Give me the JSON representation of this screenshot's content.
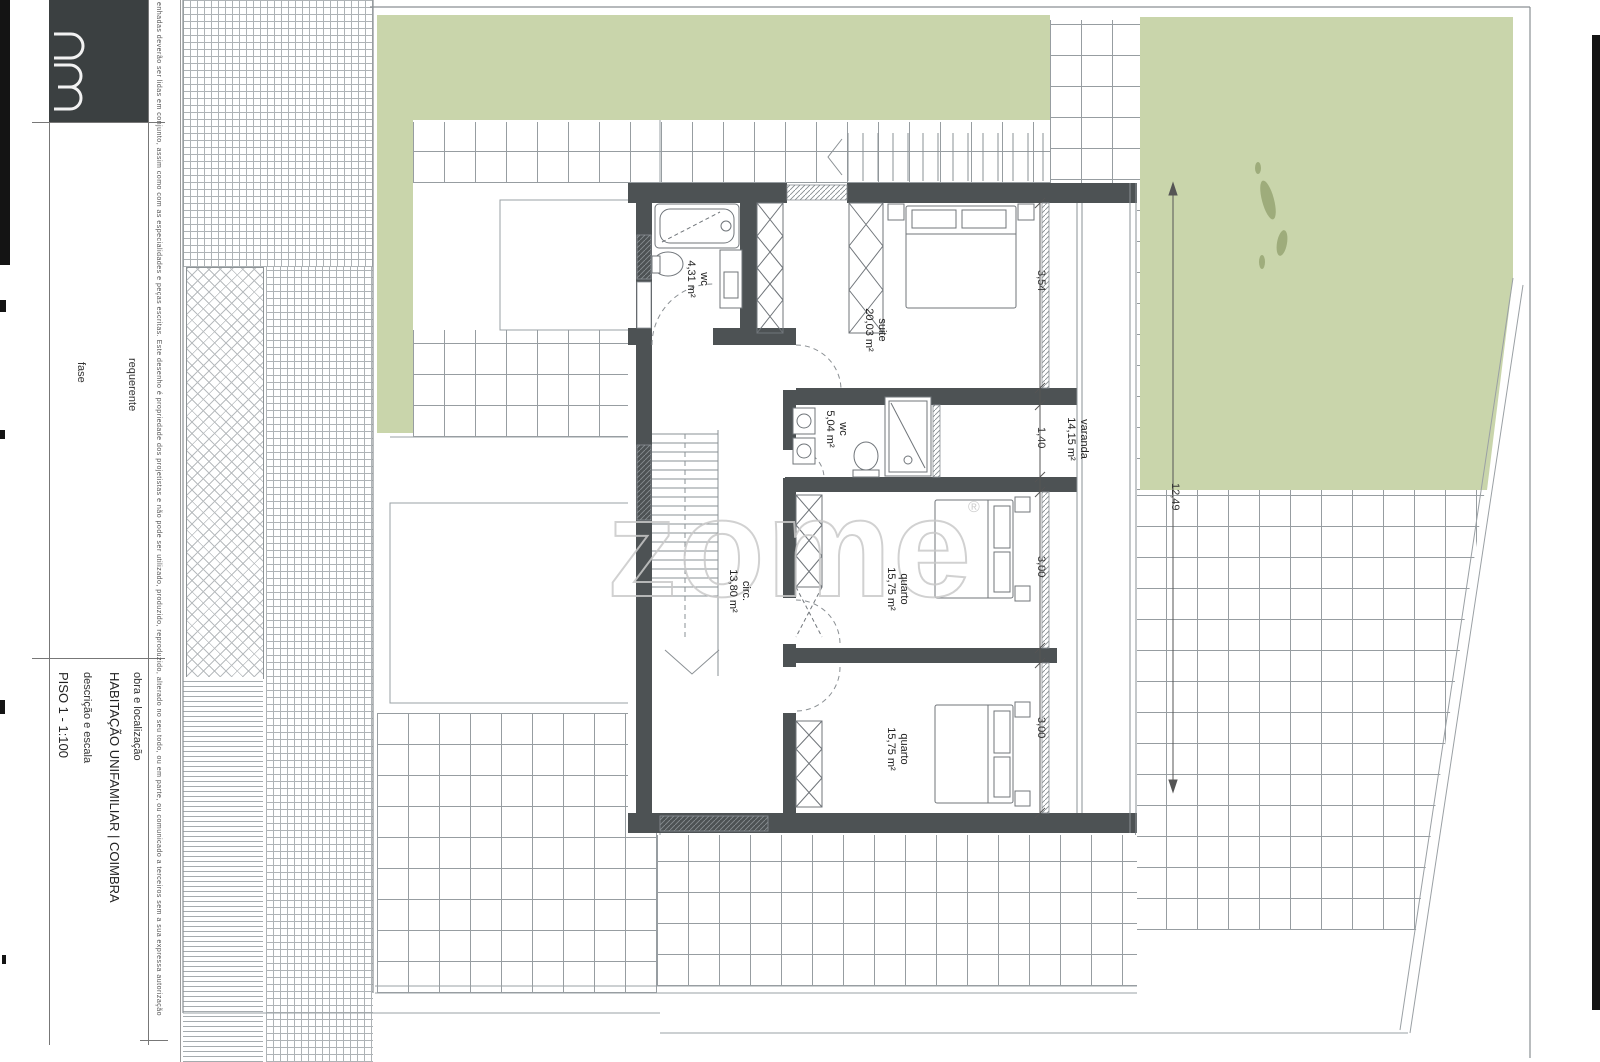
{
  "title_block": {
    "fields": [
      {
        "label": "requerente",
        "value": ""
      },
      {
        "label": "fase",
        "value": ""
      },
      {
        "label": "obra e localização",
        "value": "HABITAÇÃO UNIFAMILIAR | COIMBRA"
      },
      {
        "label": "descrição e escala",
        "value": "PISO 1 - 1:100"
      }
    ],
    "disclaimer": "enhadas deverão ser lidas em conjunto, assim como com as especialidades e peças escritas. Este desenho é propriedade dos projetistas e não pode ser utilizado, produzido, reproduzido, alterado no seu todo, ou em parte, ou comunicado a terceiros sem a sua expressa autorização"
  },
  "watermark": {
    "text": "zome",
    "reg": "®"
  },
  "plan": {
    "rooms": [
      {
        "name": "wc",
        "area": "4,31 m²"
      },
      {
        "name": "suite",
        "area": "20,03 m²"
      },
      {
        "name": "wc",
        "area": "5,04 m²"
      },
      {
        "name": "circ.",
        "area": "13,80 m²"
      },
      {
        "name": "quarto",
        "area": "15,75 m²"
      },
      {
        "name": "quarto",
        "area": "15,75 m²"
      },
      {
        "name": "varanda",
        "area": "14,15 m²"
      }
    ],
    "dimensions": [
      "3,54",
      "1,40",
      "3,00",
      "3,00",
      "12,49"
    ],
    "colors": {
      "wall": "#4d5254",
      "garden_green": "#c9d5ab",
      "paper": "#ffffff",
      "scan_edge": "#141414"
    }
  }
}
